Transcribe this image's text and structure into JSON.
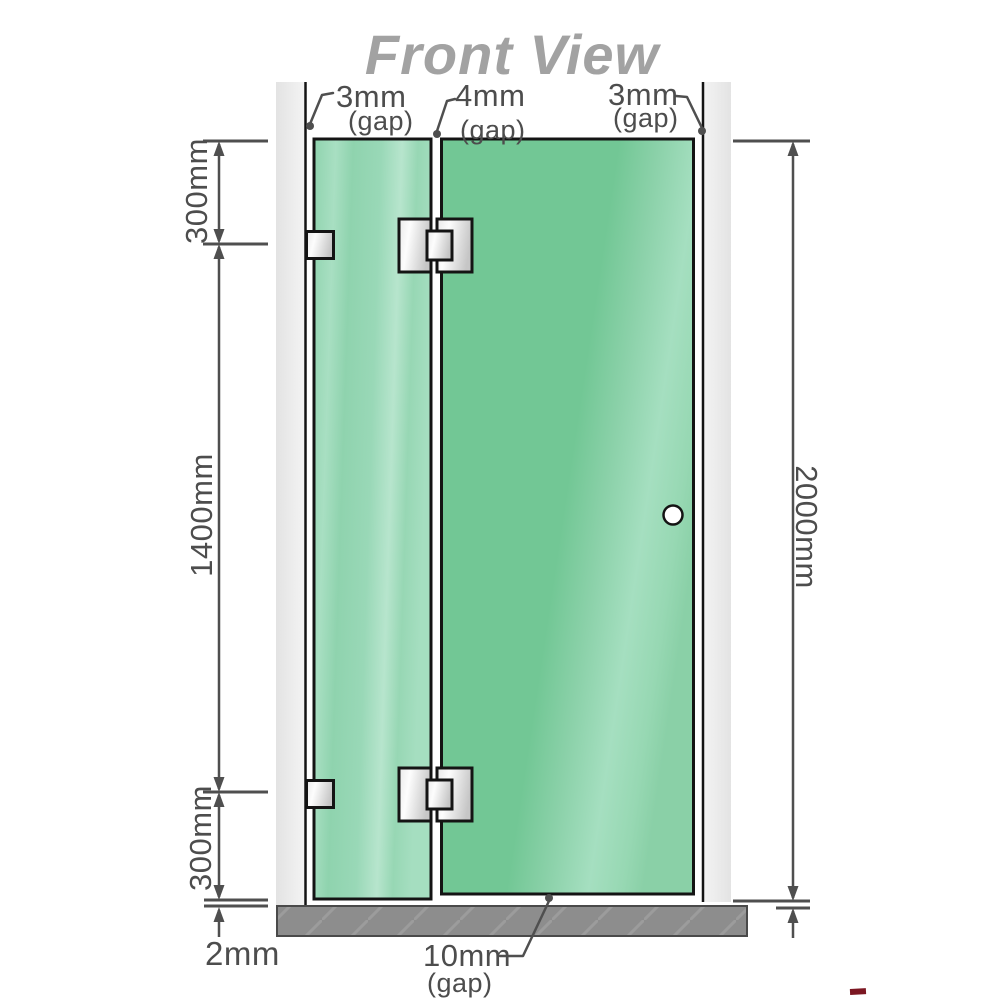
{
  "title": "Front View",
  "annotations": {
    "gap_top_left": {
      "value": "3mm",
      "note": "(gap)"
    },
    "gap_top_center": {
      "value": "4mm",
      "note": "(gap)"
    },
    "gap_top_right": {
      "value": "3mm",
      "note": "(gap)"
    },
    "gap_bottom": {
      "value": "10mm",
      "note": "(gap)"
    },
    "gap_floor": {
      "value": "2mm"
    }
  },
  "dimensions": {
    "top_section": "300mm",
    "middle_section": "1400mm",
    "bottom_section": "300mm",
    "overall_height": "2000mm"
  },
  "colors": {
    "glass_fixed_panel": "#8fd3ae",
    "glass_door_panel": "#72c795",
    "glass_highlight": "#b7e5cd",
    "wall_channel": "#e9e9e9",
    "floor": "#8d8d8d",
    "dimension_line": "#4f4f4f",
    "outline": "#141414",
    "title_text": "#a2a2a2"
  }
}
